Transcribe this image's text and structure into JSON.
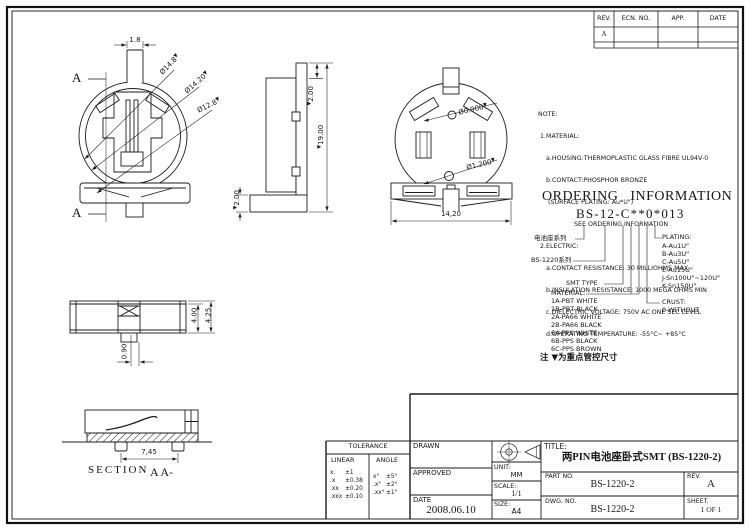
{
  "marker": "▼",
  "revision_table": {
    "headers": [
      "REV.",
      "ECN. NO.",
      "APP.",
      "DATE"
    ],
    "row": [
      "A",
      "",
      "",
      ""
    ]
  },
  "views": {
    "top": {
      "label_a_top": "A",
      "label_a_bottom": "A",
      "dim_stem": "1.8",
      "dim_dia_outer": "Ø14.8",
      "dim_dia_mid": "Ø14.20",
      "dim_dia_inner": "Ø12.8"
    },
    "side": {
      "dim_top": "2.00",
      "dim_height": "19.00",
      "dim_base": "2.00"
    },
    "front": {
      "dim_hole_small": "Ø0.900",
      "dim_hole_large": "Ø1.200",
      "dim_width": "14,20"
    },
    "profile": {
      "dim_body": "4.00",
      "dim_total": "4.25",
      "dim_offset": "0.90"
    },
    "section": {
      "title": "SECTION",
      "subtitle": "A A-",
      "dim_pitch": "7,45"
    }
  },
  "notes": {
    "lines": [
      "NOTE:",
      " 1.MATERIAL:",
      "    a.HOUSING:THERMOPLASTIC GLASS FIBRE UL94V-0",
      "    b.CONTACT:PHOSPHOR BRONZE",
      "     (SURFACE PLATING: Au*U\")",
      "                  SEE ORDERING INFORMATION",
      " 2.ELECTRIC:",
      "    a.CONTACT RESISTANCE: 30 MILLIOHMS MAX",
      "    b.INSULATION RESISTANCE: 1000 MEGA OHMS MIN",
      "    c.DIELECTRIC VOLTAGE: 750V AC ONE SEC LEVEL",
      "    d.OPERATING TEMPERATURE: -55°C~ +85°C"
    ]
  },
  "ordering": {
    "title": "ORDERING INFORMATION",
    "code": "BS-12-C**0*013",
    "series_label": "电池座系列",
    "family_label": "BS-1220系列",
    "smt_label": "SMT TYPE",
    "material_label": "MATERIAL:",
    "material_options": [
      "1A-PBT WHITE",
      "1B-PBT BLACK",
      "2A-PA66 WHITE",
      "2B-PA66 BLACK",
      "6A-PPS WHITE",
      "6B-PPS BLACK",
      "6C-PPS BROWN"
    ],
    "plating_label": "PLATING:",
    "plating_options": [
      "A-Au1U\"",
      "B-Au3U\"",
      "C-Au5U\"",
      "E-Au15U\"",
      "J-Sn100U\"~120U\"",
      "K-Sn150U\""
    ],
    "crust_label": "CRUST:",
    "crust_options": [
      "0-WITHOUT"
    ]
  },
  "control_note": "注 ▼为重点管控尺寸",
  "tolerance": {
    "title": "TOLERANCE",
    "linear_label": "LINEAR",
    "angle_label": "ANGLE",
    "linear_rows": [
      [
        "x.",
        "±1"
      ],
      [
        ".x",
        "±0.38"
      ],
      [
        ".xx",
        "±0.20"
      ],
      [
        ".xxx",
        "±0.10"
      ]
    ],
    "angle_rows": [
      [
        "x°",
        "±5°"
      ],
      [
        ".x°",
        "±2°"
      ],
      [
        ".xx°",
        "±1°"
      ]
    ]
  },
  "title_block": {
    "drawn_label": "DRAWN",
    "approved_label": "APPROVED",
    "date_label": "DATE",
    "date_value": "2008.06.10",
    "unit_label": "UNIT:",
    "unit_value": "MM",
    "scale_label": "SCALE:",
    "scale_value": "1/1",
    "size_label": "SIZE:",
    "size_value": "A4",
    "title_label": "TITLE:",
    "title_value": "两PIN电池座卧式SMT (BS-1220-2)",
    "part_label": "PART NO.",
    "part_value": "BS-1220-2",
    "rev_label": "REV.",
    "rev_value": "A",
    "dwg_label": "DWG. NO.",
    "dwg_value": "BS-1220-2",
    "sheet_label": "SHEET.",
    "sheet_value": "1 OF 1"
  }
}
